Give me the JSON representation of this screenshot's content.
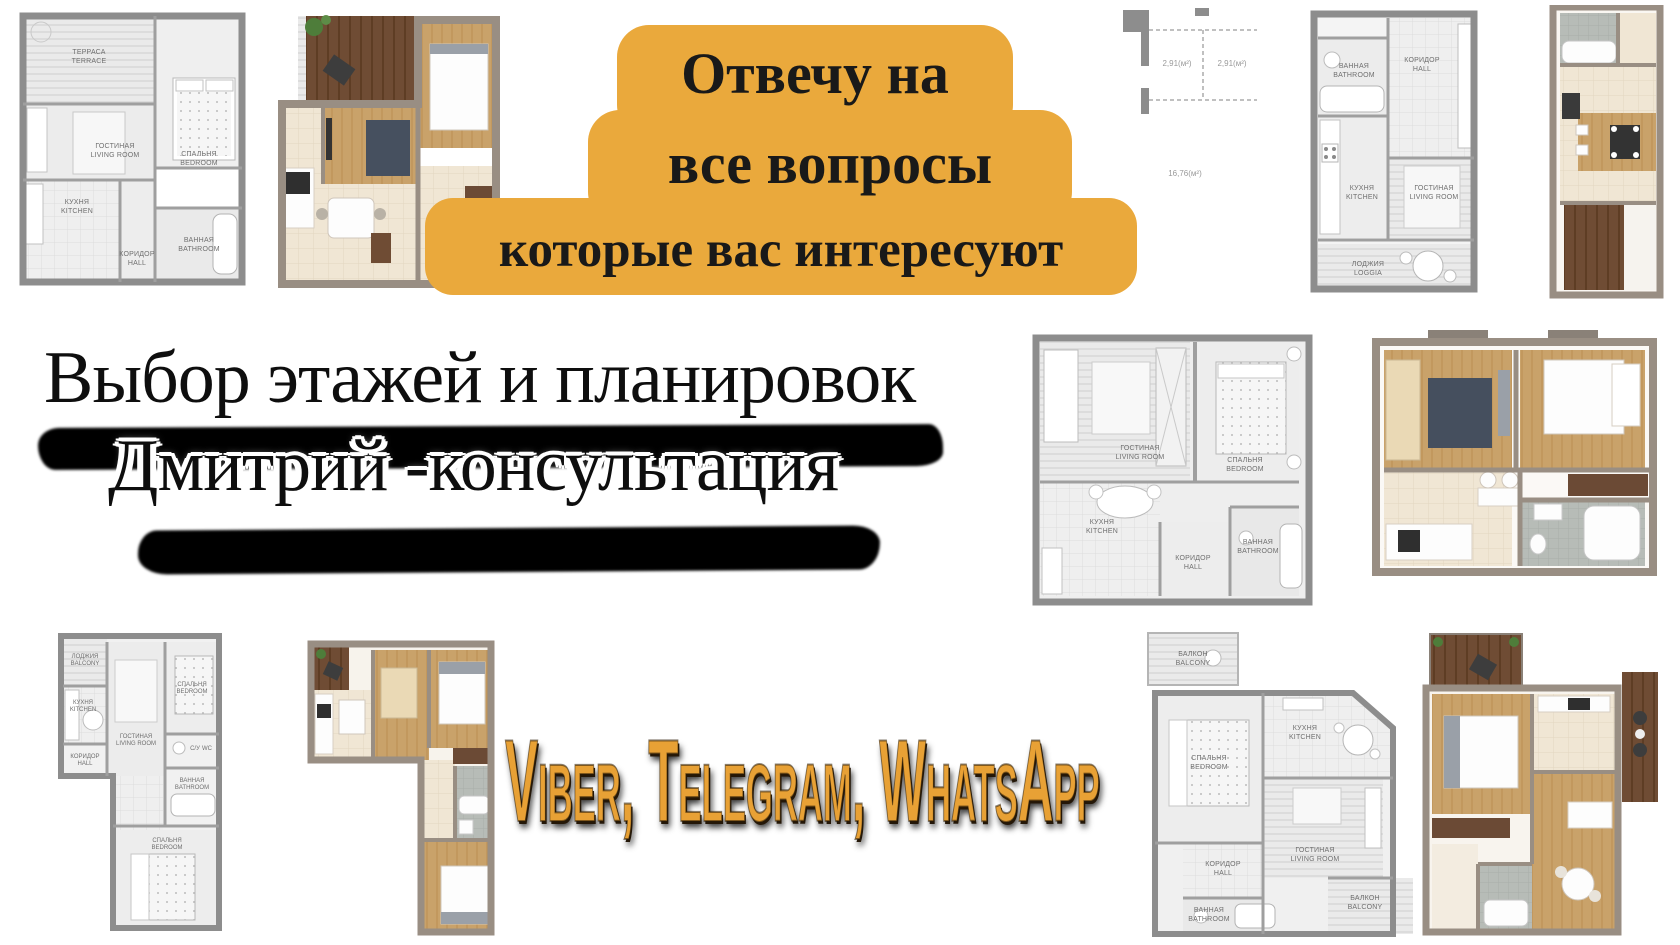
{
  "badge": {
    "bg_color": "#EAA93C",
    "line1": "Отвечу на",
    "line2": "все вопросы",
    "line3": "которые вас интересуют"
  },
  "headline": {
    "line1": "Выбор этажей и планировок",
    "line2": "Дмитрий -консультация"
  },
  "contact": {
    "messengers": "Viber, Telegram, WhatsApp",
    "color": "#E8A135"
  },
  "plans": {
    "p1": {
      "terrace_ru": "ТЕРРАСА",
      "terrace_en": "TERRACE",
      "living_ru": "ГОСТИНАЯ",
      "living_en": "LIVING ROOM",
      "bedroom_ru": "СПАЛЬНЯ",
      "bedroom_en": "BEDROOM",
      "kitchen_ru": "КУХНЯ",
      "kitchen_en": "KITCHEN",
      "hall_ru": "КОРИДОР",
      "hall_en": "HALL",
      "bath_ru": "ВАННАЯ",
      "bath_en": "BATHROOM"
    },
    "p3": {
      "area1": "2,91(м²)",
      "area2": "2,91(м²)",
      "area3": "16,76(м²)"
    },
    "p4": {
      "bath_ru": "ВАННАЯ",
      "bath_en": "BATHROOM",
      "hall_ru": "КОРИДОР",
      "hall_en": "HALL",
      "kitchen_ru": "КУХНЯ",
      "kitchen_en": "KITCHEN",
      "living_ru": "ГОСТИНАЯ",
      "living_en": "LIVING ROOM",
      "loggia_ru": "ЛОДЖИЯ",
      "loggia_en": "LOGGIA"
    },
    "p6": {
      "living_ru": "ГОСТИНАЯ",
      "living_en": "LIVING ROOM",
      "bedroom_ru": "СПАЛЬНЯ",
      "bedroom_en": "BEDROOM",
      "kitchen_ru": "КУХНЯ",
      "kitchen_en": "KITCHEN",
      "hall_ru": "КОРИДОР",
      "hall_en": "HALL",
      "bath_ru": "ВАННАЯ",
      "bath_en": "BATHROOM"
    },
    "p8": {
      "loggia_ru": "ЛОДЖИЯ",
      "loggia_en": "BALCONY",
      "kitchen_ru": "КУХНЯ",
      "kitchen_en": "KITCHEN",
      "hall_ru": "КОРИДОР",
      "hall_en": "HALL",
      "living_ru": "ГОСТИНАЯ",
      "living_en": "LIVING ROOM",
      "bedroom_ru": "СПАЛЬНЯ",
      "bedroom_en": "BEDROOM",
      "wc_ru": "С/У",
      "wc_en": "WC",
      "bath_ru": "ВАННАЯ",
      "bath_en": "BATHROOM",
      "bedroom2_ru": "СПАЛЬНЯ",
      "bedroom2_en": "BEDROOM"
    },
    "p10": {
      "balcony_ru": "БАЛКОН",
      "balcony_en": "BALCONY",
      "bedroom_ru": "СПАЛЬНЯ",
      "bedroom_en": "BEDROOM",
      "kitchen_ru": "КУХНЯ",
      "kitchen_en": "KITCHEN",
      "living_ru": "ГОСТИНАЯ",
      "living_en": "LIVING ROOM",
      "hall_ru": "КОРИДОР",
      "hall_en": "HALL",
      "bath_ru": "ВАННАЯ",
      "bath_en": "BATHROOM",
      "balcony2_ru": "БАЛКОН",
      "balcony2_en": "BALCONY"
    }
  }
}
